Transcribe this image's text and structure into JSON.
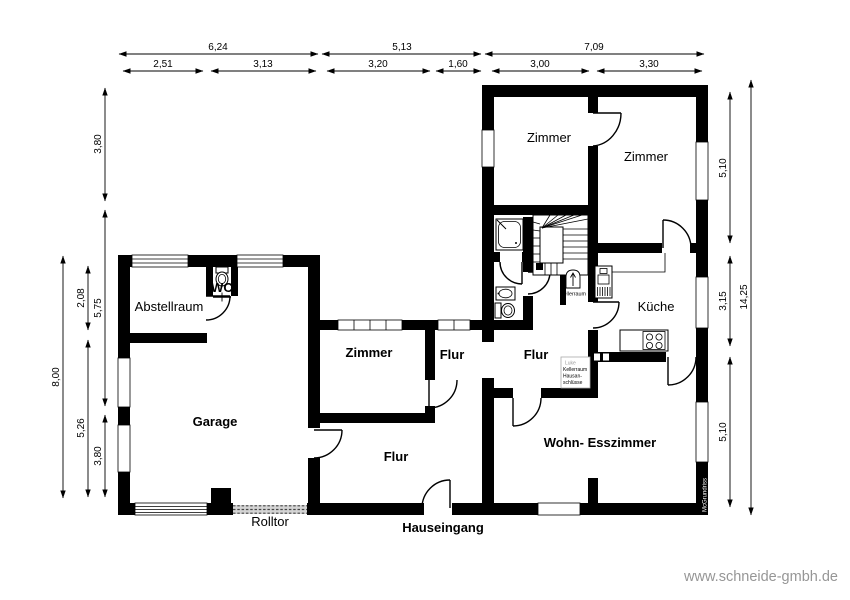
{
  "rooms": {
    "zimmer_main_left": "Zimmer",
    "zimmer_main_right": "Zimmer",
    "kueche": "Küche",
    "flur_main": "Flur",
    "zimmer_annex": "Zimmer",
    "flur_annex_small": "Flur",
    "flur_annex_large": "Flur",
    "wohn_esszimmer": "Wohn- Esszimmer",
    "abstellraum": "Abstellraum",
    "garage": "Garage"
  },
  "labels": {
    "wc": "WC",
    "kellerraum": "Kellerraum",
    "rolltor": "Rolltor",
    "hauseingang": "Hauseingang"
  },
  "note_box": {
    "lines": [
      "Luke",
      "Kellerraum",
      "Hausan-",
      "schlüsse"
    ]
  },
  "dimensions": {
    "top_outer": [
      "6,24",
      "5,13",
      "7,09"
    ],
    "top_inner": [
      "2,51",
      "3,13",
      "3,20",
      "1,60",
      "3,00",
      "3,30"
    ],
    "left_inner": [
      "3,80",
      "5,75",
      "3,80"
    ],
    "left_mid": [
      "2,08",
      "5,26"
    ],
    "left_outer": [
      "8,00"
    ],
    "right_inner": [
      "5,10",
      "3,15",
      "5,10"
    ],
    "right_outer": [
      "14,25"
    ]
  },
  "branding": {
    "plan_watermark": "McGrundriss",
    "website": "www.schneide-gmbh.de"
  },
  "colors": {
    "wall": "#000000",
    "background": "#ffffff",
    "rolltor_fill": "#d4d4d4",
    "note_border": "#aaaaaa",
    "note_gray_text": "#9b9b9b",
    "website_text": "#969696"
  }
}
